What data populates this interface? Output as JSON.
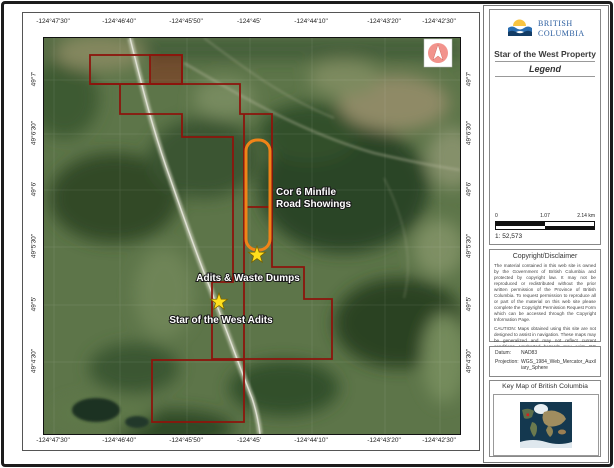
{
  "map": {
    "lon_labels": [
      "-124°47'30\"",
      "-124°46'40\"",
      "-124°45'50\"",
      "-124°45'",
      "-124°44'10\"",
      "-124°43'20\"",
      "-124°42'30\""
    ],
    "lat_labels": [
      "49°7'",
      "49°6'30\"",
      "49°6'",
      "49°5'30\"",
      "49°5'",
      "49°4'30\""
    ],
    "annotations": {
      "minfile_line1": "Cor 6 Minfile",
      "minfile_line2": "Road Showings",
      "adits_waste": "Adits & Waste Dumps",
      "star_west": "Star of the West Adits"
    },
    "colors": {
      "claim_outline": "#8c150c",
      "claim_fill": "rgba(150,25,12,0.4)",
      "highlight_outline": "#f08418",
      "star_fill": "#ffdf1d"
    }
  },
  "sidebar": {
    "logo": {
      "line1": "BRITISH",
      "line2": "COLUMBIA"
    },
    "title": "Star of the West Property",
    "legend_heading": "Legend",
    "scalebar": {
      "tick0": "0",
      "tick1": "1.07",
      "tick2": "2.14 km",
      "ratio": "1: 52,573"
    },
    "copyright": {
      "heading": "Copyright/Disclaimer",
      "body": "The material contained in this web site is owned by the Government of British Columbia and protected by copyright law. It may not be reproduced or redistributed without the prior written permission of the Province of British Columbia. To request permission to reproduce all or part of the material on this web site please complete the Copyright Permission Request Form which can be accessed through the Copyright Information Page.",
      "caution": "CAUTION: Maps obtained using this site are not designed to assist in navigation. These maps may be generalized and may not reflect current conditions. Uncharted hazards may exist. DO NOT USE THESE MAPS FOR NAVIGATIONAL PURPOSES."
    },
    "datum": {
      "datum_label": "Datum:",
      "datum_value": "NAD83",
      "projection_label": "Projection:",
      "projection_value": "WGS_1984_Web_Mercator_Auxiliary_Sphere"
    },
    "keymap_heading": "Key Map of British Columbia"
  }
}
